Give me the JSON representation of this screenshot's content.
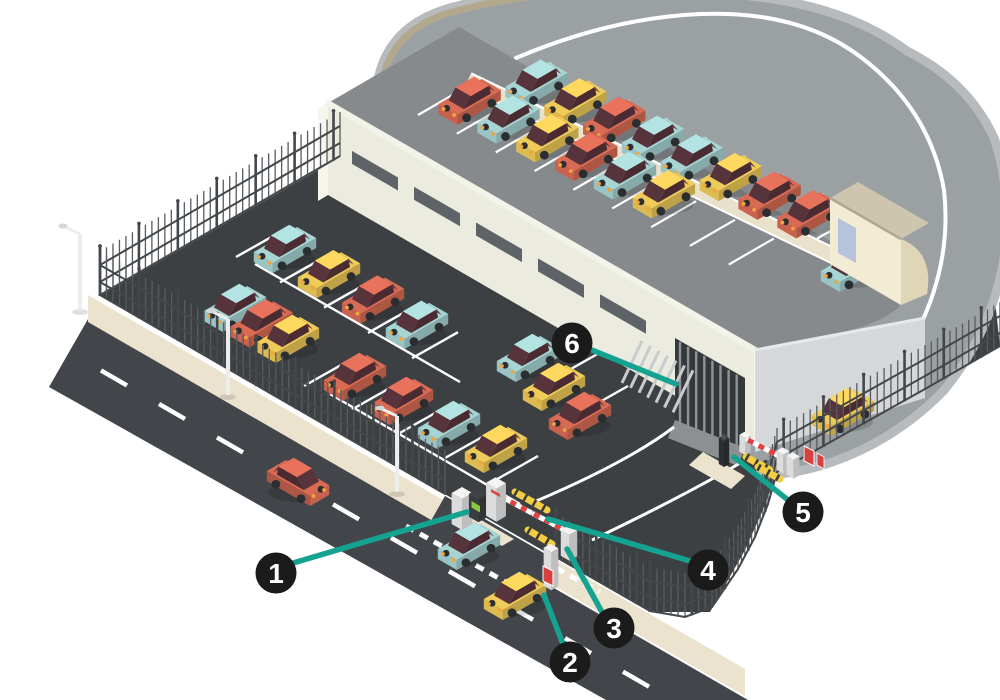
{
  "figure": {
    "type": "isometric-infographic",
    "subject": "Gated parking facility with rooftop deck, surface lot, street entrance and numbered access-control callouts"
  },
  "palette": {
    "bg": "#ffffff",
    "leader": "#14a390",
    "callout_bg": "#1b1b1b",
    "callout_text": "#ffffff",
    "band": "#9ba0a3",
    "band_bevel": "#b8bbbd",
    "curb": "#b2a88e",
    "lane": "#ffffff",
    "deck": "#868a8d",
    "walkway": "#e9e1cb",
    "building": "#ebebdf",
    "building_light": "#f6f6ec",
    "parapet": "#f2f3e9",
    "window": "#5e6367",
    "door_dark": "#34383b",
    "grille": "#8f9497",
    "slat": "#c9cccd",
    "se_wall": "#d5d7d8",
    "stair_front": "#f2ecd4",
    "stair_side": "#dfd6b8",
    "stair_roof": "#cdc5ae",
    "stair_door": "#b7c3db",
    "lot": "#3c4043",
    "street": "#42464a",
    "sidewalk": "#ebe3ce",
    "fence": "#585c60",
    "fence_dark": "#43474a",
    "pole": "#ededed",
    "car_teal": "#a7d5d4",
    "car_yellow": "#efcb59",
    "car_red": "#d96b55",
    "car_window": "#57333b",
    "wheel": "#2b2e31",
    "headlight": "#f2a53c",
    "kiosk": "#3f4347",
    "screen": "#8dc63f",
    "cabinet": "#f4f4f4",
    "barrier_red": "#e04242",
    "bump": "#f2cd45",
    "bump_dark": "#3a3a3a",
    "sign_red": "#d5413e",
    "bollard": "#303437"
  },
  "callouts": [
    {
      "number": "1",
      "target": "entry-ticket-kiosk"
    },
    {
      "number": "2",
      "target": "sidewalk-island"
    },
    {
      "number": "3",
      "target": "gate-pillar"
    },
    {
      "number": "4",
      "target": "barrier-arm"
    },
    {
      "number": "5",
      "target": "exit-bollard"
    },
    {
      "number": "6",
      "target": "garage-gate"
    }
  ],
  "scene": {
    "areas": [
      "street",
      "sidewalk",
      "surface-parking-lot",
      "perimeter-fence",
      "parking-structure",
      "rooftop-deck",
      "ring-road",
      "entry-gate",
      "exit-gate",
      "stair-tower"
    ],
    "vehicles": {
      "deck_upper_row": [
        "teal",
        "yellow",
        "red",
        "teal",
        "teal",
        "yellow",
        "red",
        "red"
      ],
      "deck_lower_row": [
        "red",
        "teal",
        "yellow",
        "red",
        "teal",
        "yellow"
      ],
      "deck_by_stairhouse": [
        "teal"
      ],
      "lot_row_upper": [
        "teal",
        "yellow",
        "red",
        "teal"
      ],
      "lot_cluster_left": [
        "teal",
        "red",
        "yellow"
      ],
      "lot_row_middle": [
        "red",
        "red",
        "teal",
        "yellow"
      ],
      "lot_cluster_right": [
        "teal",
        "yellow",
        "red"
      ],
      "street": [
        "red",
        "teal",
        "yellow"
      ],
      "ramp": [
        "yellow"
      ]
    }
  }
}
